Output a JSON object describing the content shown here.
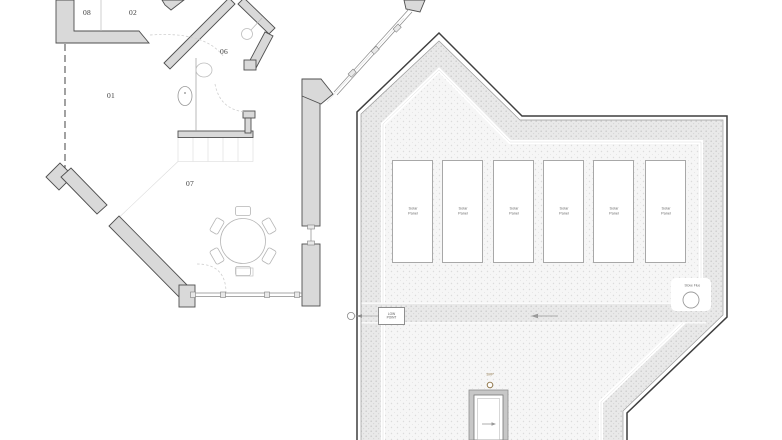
{
  "plan": {
    "floor": {
      "rooms": [
        {
          "number": "01"
        },
        {
          "number": "02"
        },
        {
          "number": "06"
        },
        {
          "number": "07"
        },
        {
          "number": "08"
        }
      ]
    },
    "roof": {
      "solar_panels": [
        {
          "label": "Solar Panel"
        },
        {
          "label": "Solar Panel"
        },
        {
          "label": "Solar Panel"
        },
        {
          "label": "Solar Panel"
        },
        {
          "label": "Solar Panel"
        },
        {
          "label": "Solar Panel"
        }
      ],
      "low_point_label": "LOW POINT",
      "stove_flue_label": "Stove Flue",
      "svp_label": "SVP"
    },
    "colors": {
      "wall_fill": "#d9d9d9",
      "line_dark": "#4f4f4f",
      "roof_outline": "#3f3f3f",
      "stipple_light": "#dcdcdc",
      "stipple_dense": "#cfcfcf",
      "svp_accent": "#8a6f3f"
    }
  }
}
